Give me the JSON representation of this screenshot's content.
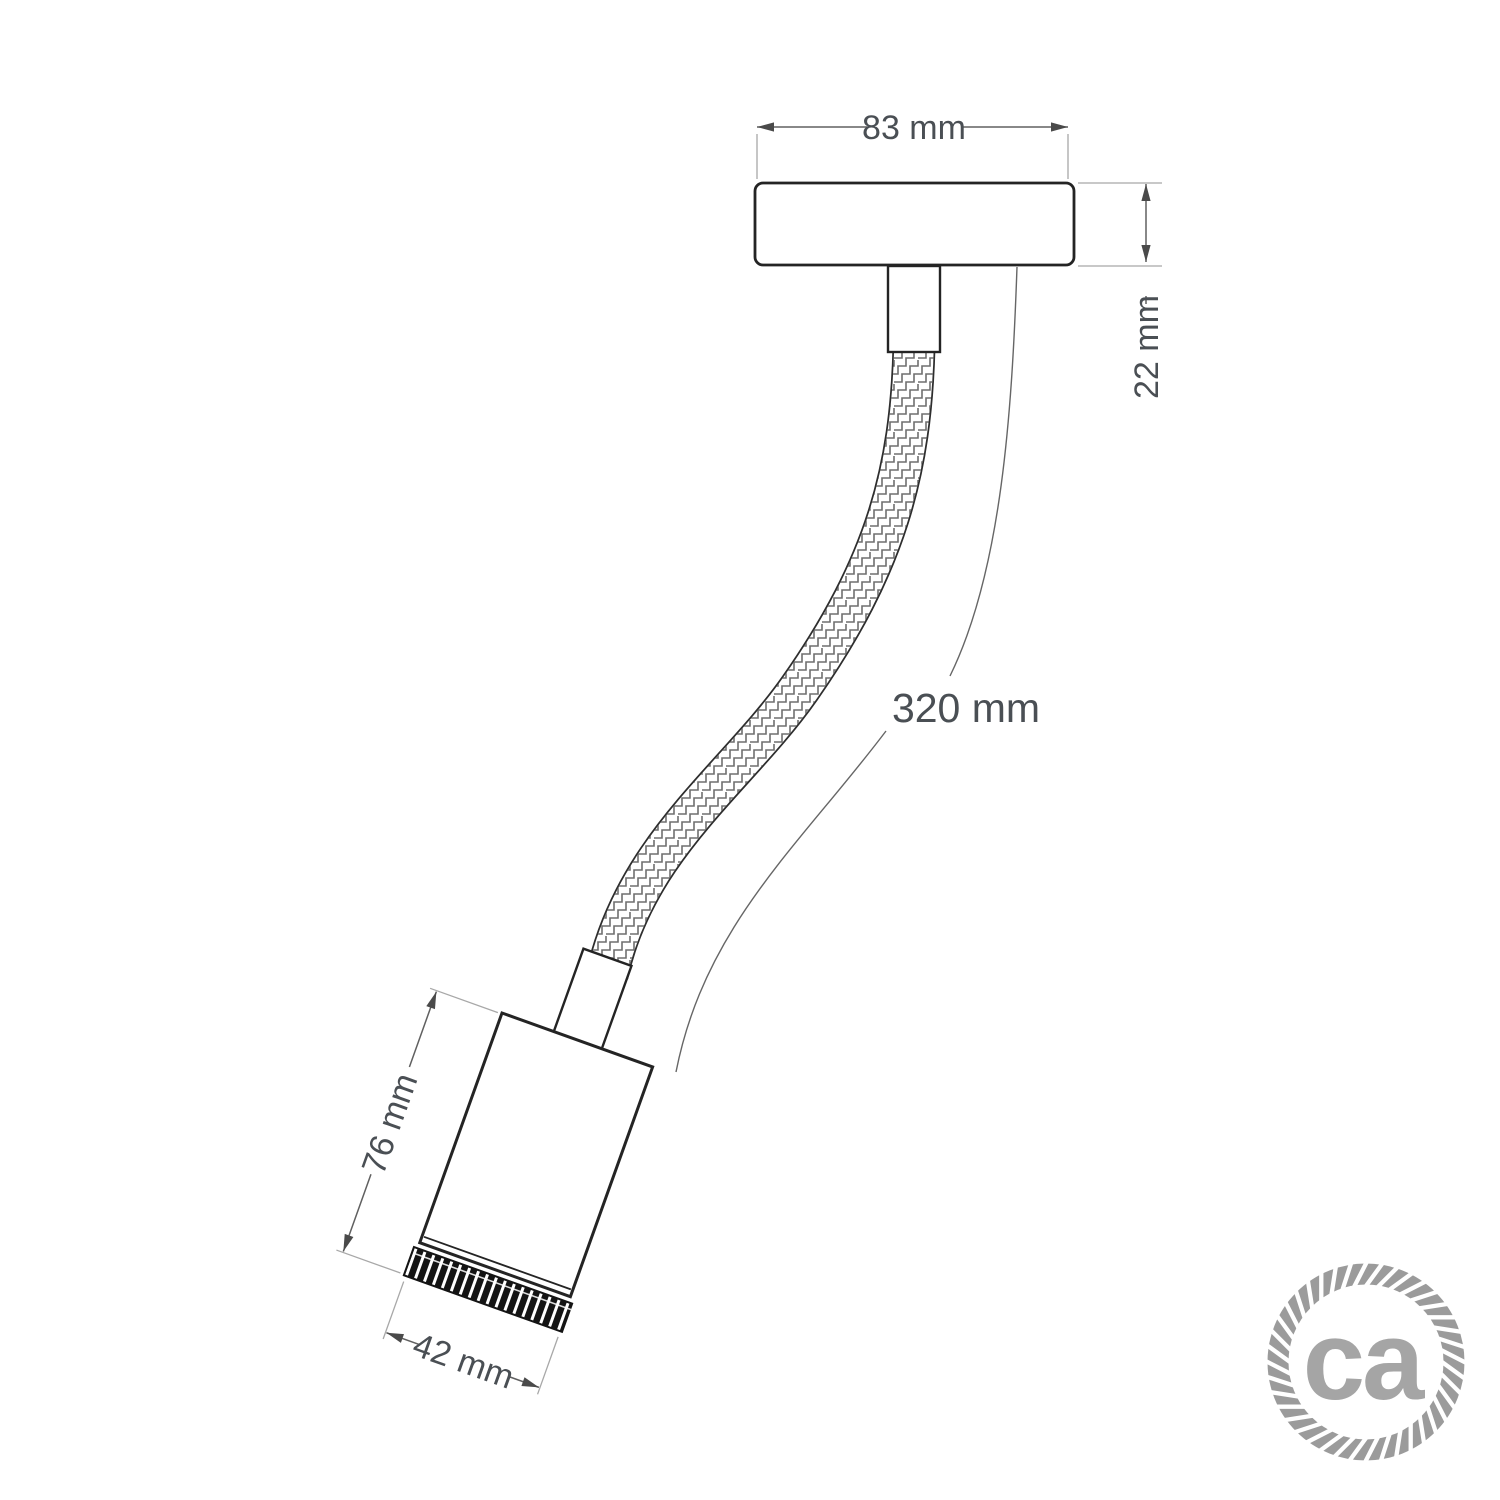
{
  "dimensions": {
    "canopy_width": "83 mm",
    "canopy_height": "22 mm",
    "arm_length": "320 mm",
    "body_height": "76 mm",
    "body_diameter": "42 mm"
  },
  "logo": {
    "text": "ca"
  },
  "colors": {
    "background": "#ffffff",
    "outline": "#242424",
    "dim_line": "#606060",
    "extension_line": "#a8a8a8",
    "dim_text": "#4a4f54",
    "arrow": "#4a4a4a",
    "braid_pattern": "#6f6f6f",
    "knurl": "#141414",
    "logo_text": "#a5a5a5",
    "logo_ring": "#9b9b9b"
  }
}
